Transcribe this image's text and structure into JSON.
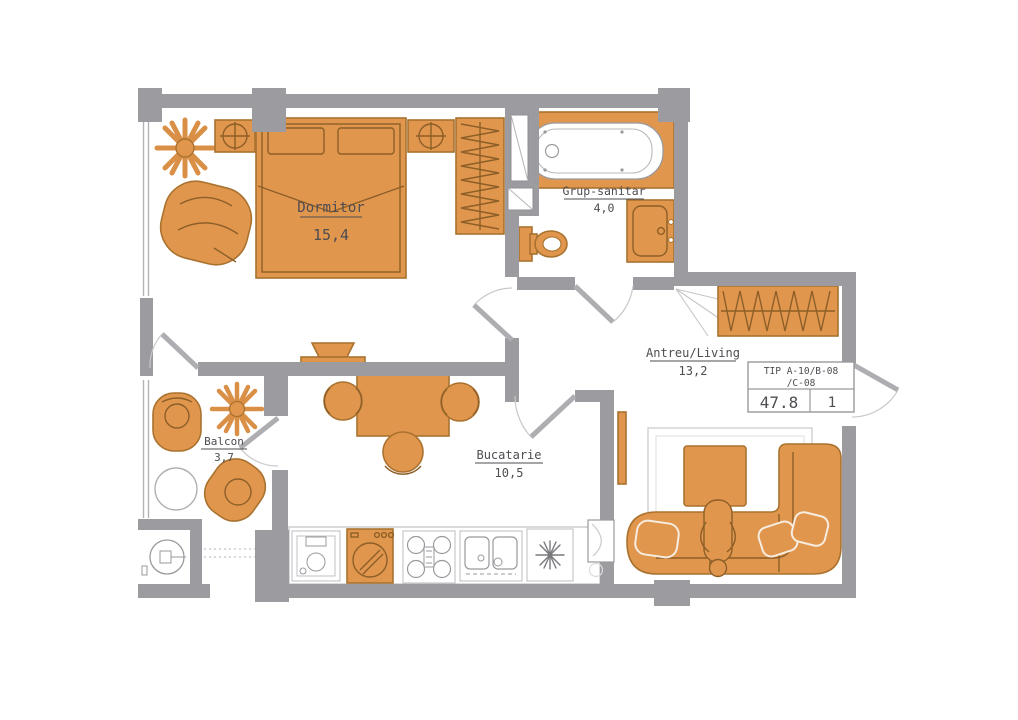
{
  "plan": {
    "colors": {
      "wall": "#9c9ca0",
      "furniture": "#e1964d",
      "furniture_outline": "#a9722f",
      "thin_line": "#b4b4b8",
      "label_text": "#4d4d52",
      "background": "#ffffff"
    },
    "rooms": [
      {
        "id": "dormitor",
        "name": "Dormitor",
        "area": "15,4"
      },
      {
        "id": "grup-sanitar",
        "name": "Grup-sanitar",
        "area": "4,0"
      },
      {
        "id": "antreu-living",
        "name": "Antreu/Living",
        "area": "13,2"
      },
      {
        "id": "bucatarie",
        "name": "Bucatarie",
        "area": "10,5"
      },
      {
        "id": "balcon",
        "name": "Balcon",
        "area": "3,7"
      }
    ],
    "title_block": {
      "type_line1": "TIP A-10/B-08",
      "type_line2": "/C-08",
      "total_area": "47.8",
      "rooms_count": "1"
    }
  }
}
